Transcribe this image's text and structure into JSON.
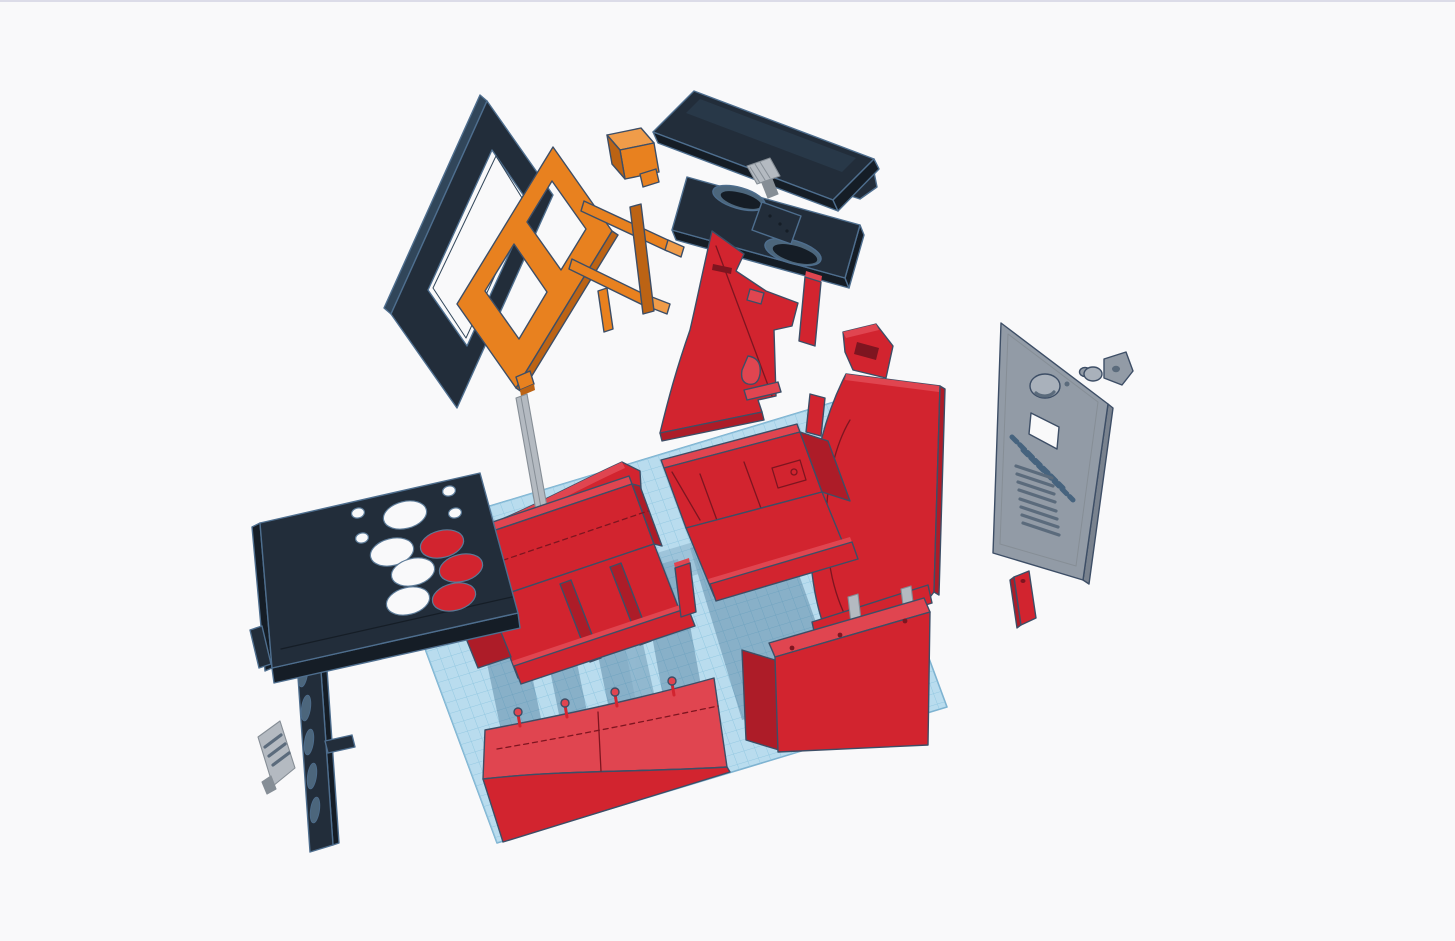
{
  "scene": {
    "type": "3d-cad-viewport",
    "description": "Exploded view of a mini arcade cabinet 3D model floating above a workplane",
    "view": "isometric"
  },
  "palette": {
    "background": "#f9f9fa",
    "top_border": "#dcdce8",
    "outline_warm": "#3d4e66",
    "outline_cool": "#4e6e8e",
    "red": "#d2242f",
    "red_light": "#e04550",
    "red_dark": "#ad1c28",
    "red_deep": "#7e1520",
    "dark": "#222d3a",
    "dark_light": "#31465a",
    "dark_deep": "#151d26",
    "dark_fill": "#4c667c",
    "orange": "#e8811f",
    "orange_light": "#f09c49",
    "orange_dark": "#bc6314",
    "gray": "#929ba6",
    "gray_light": "#a9b1bb",
    "gray_dark": "#79828e",
    "gray_deep": "#5b6b7c",
    "steel": "#b4bac1",
    "steel_dark": "#868e96",
    "plane": "#b9dcee",
    "plane_line": "#93c8e1",
    "plane_edge": "#7eb3d1",
    "shadow": "#3a6a8c",
    "engraving": "#46637e",
    "hole_rim": "#5b7a97"
  },
  "workplane": {
    "grid_visible": true,
    "cell_px": 11
  },
  "parts": [
    {
      "id": "workplane",
      "label": "Workplane grid",
      "color": "plane"
    },
    {
      "id": "screen-bezel",
      "label": "Screen bezel panel",
      "color": "dark"
    },
    {
      "id": "monitor-frame",
      "label": "Orange monitor mounting frame",
      "color": "orange"
    },
    {
      "id": "mount-block",
      "label": "Orange mount block",
      "color": "orange"
    },
    {
      "id": "monitor-panel",
      "label": "Flat monitor panel",
      "color": "dark"
    },
    {
      "id": "vesa-bracket",
      "label": "VESA mount bracket",
      "color": "steel"
    },
    {
      "id": "speaker-panel",
      "label": "Speaker panel with oval cutouts",
      "color": "dark"
    },
    {
      "id": "side-panel-left",
      "label": "Cabinet side panel (left)",
      "color": "red"
    },
    {
      "id": "side-panel-right",
      "label": "Cabinet side panel (right)",
      "color": "red"
    },
    {
      "id": "upper-front-panel",
      "label": "Upper curved front panel",
      "color": "red"
    },
    {
      "id": "support-pole",
      "label": "Support pole",
      "color": "steel"
    },
    {
      "id": "base-box-left",
      "label": "Base section (left)",
      "color": "red"
    },
    {
      "id": "base-box-right",
      "label": "Base section (right)",
      "color": "red"
    },
    {
      "id": "divider-stick",
      "label": "Small divider strip",
      "color": "red"
    },
    {
      "id": "front-curved-panel",
      "label": "Curved lower front panel",
      "color": "red"
    },
    {
      "id": "base-box-front",
      "label": "Front base box",
      "color": "red"
    },
    {
      "id": "control-panel",
      "label": "Control panel with button holes",
      "color": "dark"
    },
    {
      "id": "vent-strip",
      "label": "Vented side strip",
      "color": "dark"
    },
    {
      "id": "io-plate",
      "label": "Small vented plate",
      "color": "steel"
    },
    {
      "id": "back-door",
      "label": "Back access door with vents",
      "color": "gray"
    },
    {
      "id": "door-lock",
      "label": "Cam lock and barrel",
      "color": "steel"
    },
    {
      "id": "red-strip",
      "label": "Small red strip",
      "color": "red"
    }
  ]
}
